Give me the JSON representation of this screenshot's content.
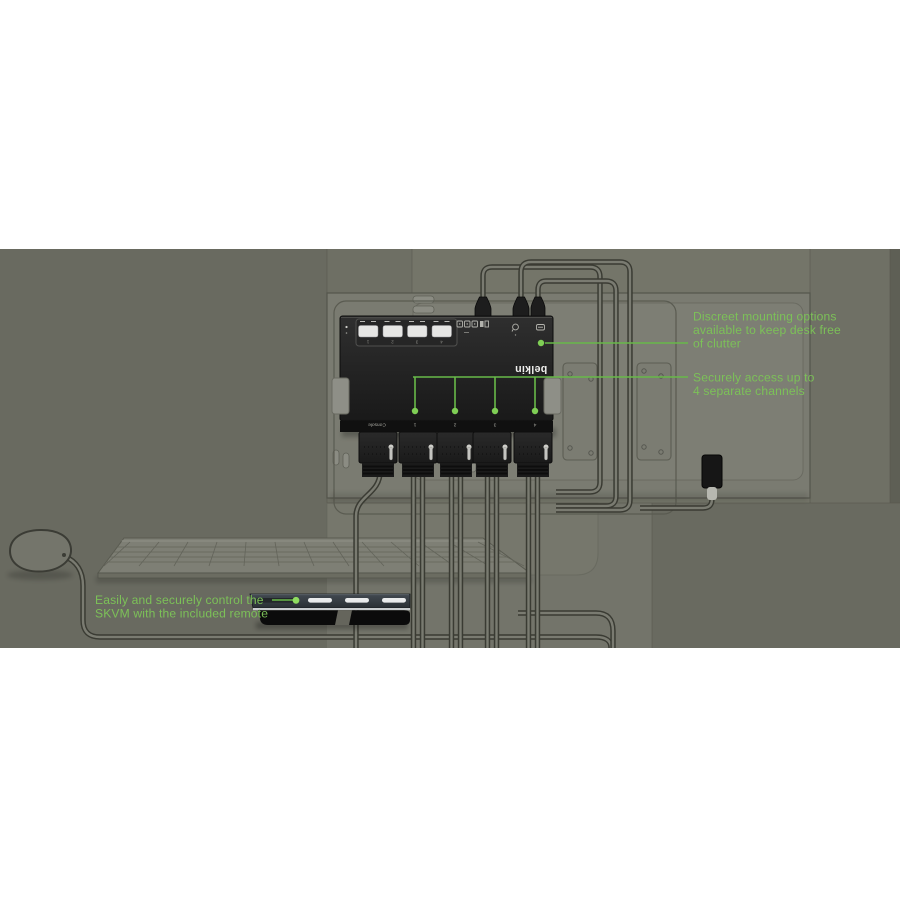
{
  "scene": {
    "description": "Belkin secure KVM switch mounted on monitor back with cables, keyboard, mouse and remote"
  },
  "annotations": {
    "mounting": {
      "line1": "Discreet mounting options",
      "line2": "available to keep desk free",
      "line3": "of clutter"
    },
    "channels": {
      "line1": "Securely access up to",
      "line2": "4 separate channels"
    },
    "remote": {
      "line1": "Easily and securely control the",
      "line2": "SKVM with the included remote"
    }
  },
  "device": {
    "brand": "belkin",
    "console_label": "Console",
    "port_labels": [
      "1",
      "2",
      "3",
      "4"
    ],
    "button_labels": [
      "1",
      "2",
      "3",
      "4"
    ]
  },
  "colors": {
    "accent_green_text": "#7cc158",
    "accent_green_line": "#68b949",
    "background_olive": "#696a60",
    "device_black": "#1d1d1d"
  }
}
